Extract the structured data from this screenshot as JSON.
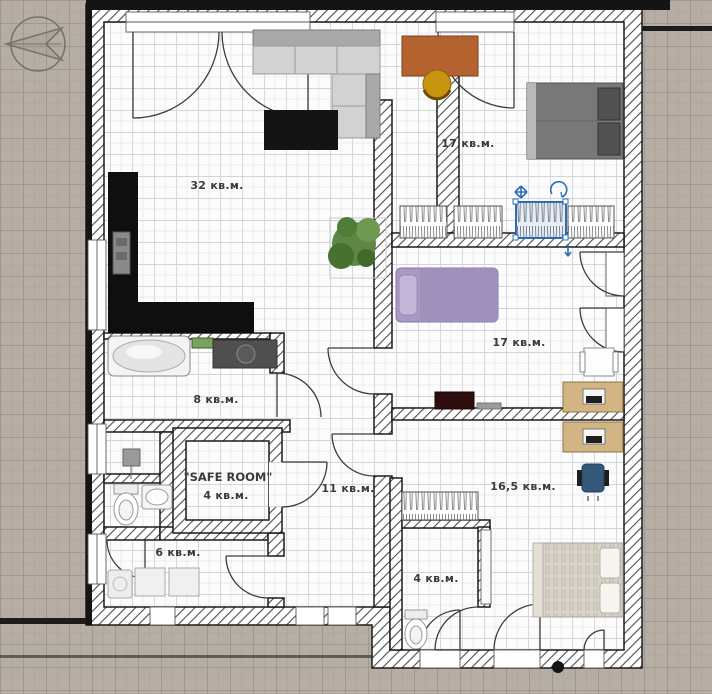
{
  "plan": {
    "type": "apartment-floor-plan",
    "units_suffix": "кв.м.",
    "compass": "north-arrow"
  },
  "rooms": {
    "living_kitchen": {
      "area_label": "32 кв.м."
    },
    "bedroom_top_right": {
      "area_label": "17 кв.м."
    },
    "bedroom_middle_right": {
      "area_label": "17 кв.м."
    },
    "bathroom": {
      "area_label": "8 кв.м."
    },
    "safe_room": {
      "name_label": "\"SAFE ROOM\"",
      "area_label": "4 кв.м."
    },
    "hallway": {
      "area_label": "11 кв.м."
    },
    "utility": {
      "area_label": "6 кв.м."
    },
    "bedroom_bottom_right": {
      "area_label": "16,5 кв.м."
    },
    "wc_bottom": {
      "area_label": "4 кв.м."
    }
  },
  "furniture": {
    "living_kitchen": [
      {
        "name": "corner-sofa",
        "color": "#cfcfcf"
      },
      {
        "name": "tv-stand",
        "color": "#141414"
      },
      {
        "name": "kitchen-counter-l-shape",
        "color": "#0f0f0f"
      },
      {
        "name": "built-in-appliance",
        "color": "#8a8a8a"
      },
      {
        "name": "plant",
        "color": "#5d8743"
      }
    ],
    "bedroom_top_right": [
      {
        "name": "desk",
        "color": "#b4632f"
      },
      {
        "name": "chair",
        "color": "#c8930f"
      },
      {
        "name": "double-bed",
        "color": "#787878"
      },
      {
        "name": "wardrobes-with-clothes",
        "color": "#ffffff"
      },
      {
        "name": "wardrobe-selected",
        "color": "#2e6cb5"
      }
    ],
    "bedroom_middle_right": [
      {
        "name": "single-bed",
        "color": "#a899c2"
      },
      {
        "name": "tv",
        "color": "#2e0d0d"
      },
      {
        "name": "chair-with-table",
        "color": "#fdfdfd"
      },
      {
        "name": "desk-with-computer",
        "color": "#d3b584"
      }
    ],
    "bathroom": [
      {
        "name": "bathtub",
        "color": "#f4f4f4"
      },
      {
        "name": "vanity-sink",
        "color": "#4f4f4f"
      },
      {
        "name": "shelf",
        "color": "#79a25c"
      }
    ],
    "wc": [
      {
        "name": "toilet"
      },
      {
        "name": "sink"
      },
      {
        "name": "water-heater"
      }
    ],
    "utility": [
      {
        "name": "shower-tray"
      },
      {
        "name": "washer"
      },
      {
        "name": "washer"
      }
    ],
    "bedroom_bottom_right": [
      {
        "name": "desk-with-computer",
        "color": "#d3b584"
      },
      {
        "name": "office-chair",
        "color": "#33597a"
      },
      {
        "name": "double-bed-striped",
        "color": "#d8d4c9"
      },
      {
        "name": "sliding-mirror-door"
      }
    ],
    "wc_bottom": [
      {
        "name": "toilet"
      },
      {
        "name": "wardrobe-with-clothes"
      }
    ]
  },
  "selection": {
    "selected_object": "wardrobe",
    "accent_color": "#2e6cb5",
    "handles": [
      "move-cross",
      "rotate-arc",
      "resize-arrow"
    ]
  },
  "colors": {
    "background_tile": "#b6aea5",
    "floor_grid": "#fcfcfd",
    "wall_outline": "#1b1b1b",
    "selection_blue": "#2e6cb5"
  }
}
